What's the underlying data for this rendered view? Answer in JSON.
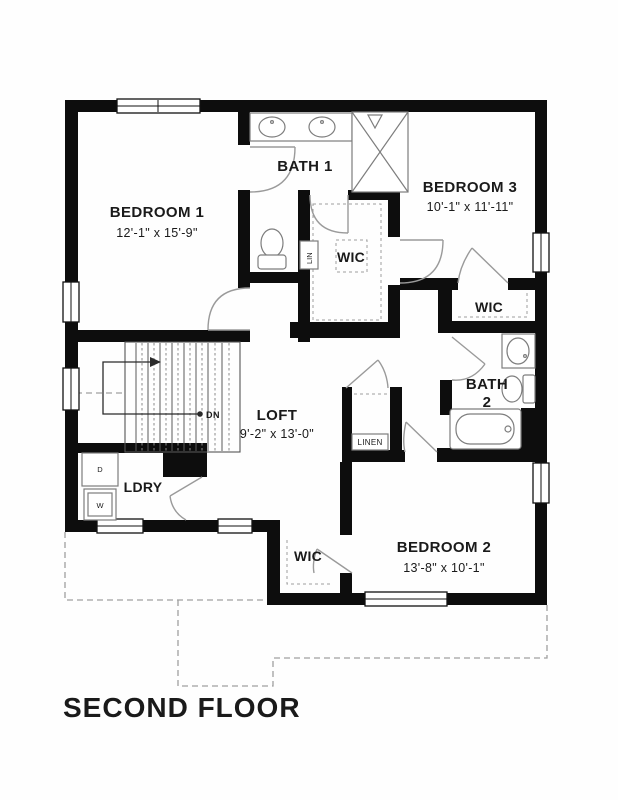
{
  "title": "SECOND FLOOR",
  "rooms": {
    "bedroom1": {
      "name": "BEDROOM 1",
      "dims": "12'-1\" x 15'-9\""
    },
    "bedroom2": {
      "name": "BEDROOM 2",
      "dims": "13'-8\" x 10'-1\""
    },
    "bedroom3": {
      "name": "BEDROOM 3",
      "dims": "10'-1\" x 11'-11\""
    },
    "loft": {
      "name": "LOFT",
      "dims": "9'-2\" x 13'-0\""
    },
    "bath1": {
      "name": "BATH 1"
    },
    "bath2": {
      "line1": "BATH",
      "line2": "2"
    },
    "laundry": {
      "name": "LDRY"
    },
    "wic_master": {
      "name": "WIC"
    },
    "wic_bedroom3": {
      "name": "WIC"
    },
    "wic_bedroom2": {
      "name": "WIC"
    }
  },
  "closets": {
    "linen_hall": "LINEN",
    "linen_bath": "LIN"
  },
  "stairs": {
    "direction_label": "DN"
  },
  "appliances": {
    "dryer": "D",
    "washer": "W"
  },
  "colors": {
    "walls": "#0d0d0d",
    "fixtures": "#7d7d7d",
    "doors": "#9a9a9a",
    "dashed_outline": "#a0a0a0",
    "text": "#1a1a1a",
    "background": "#ffffff"
  }
}
